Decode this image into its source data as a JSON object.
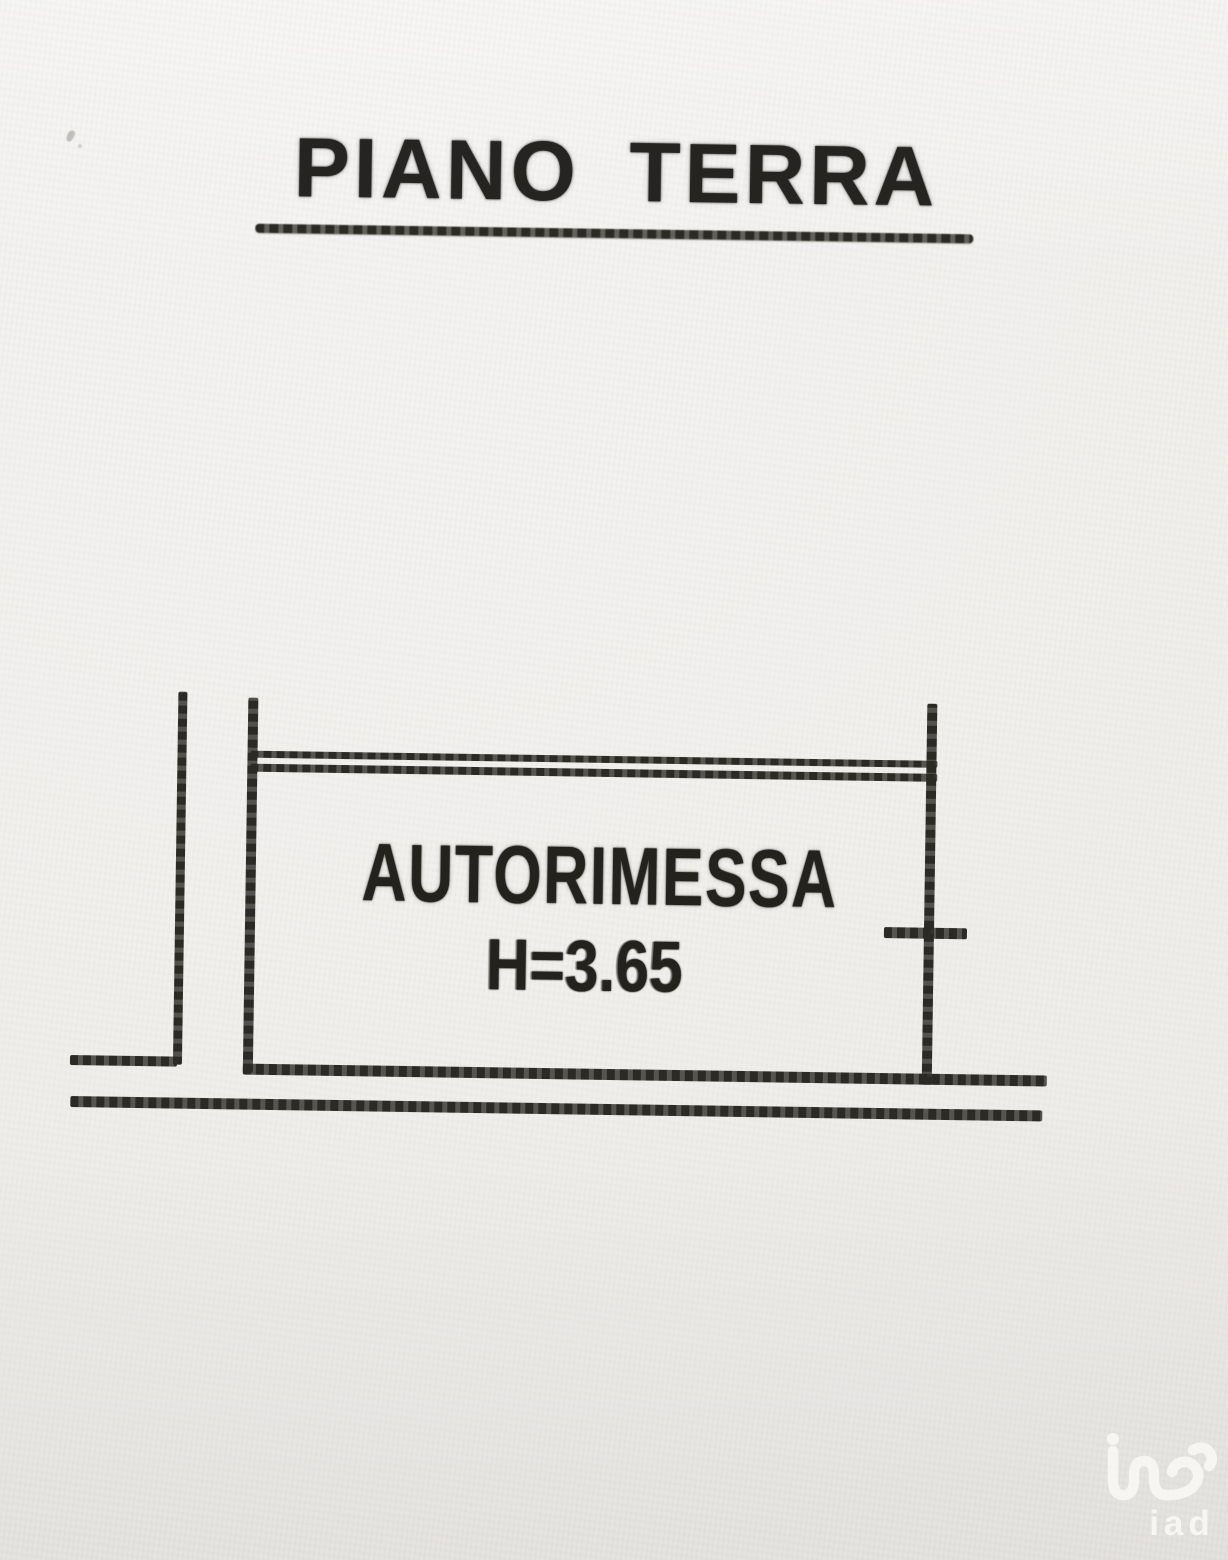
{
  "plan": {
    "title": "PIANO TERRA",
    "room": {
      "name": "AUTORIMESSA",
      "height_label": "H=3.65"
    }
  },
  "watermark": {
    "brand": "iad",
    "logo_icon": "iad-logo-monogram"
  },
  "colors": {
    "paper": "#f0efec",
    "ink": "#2b2a24",
    "watermark": "#f9f8f5"
  }
}
